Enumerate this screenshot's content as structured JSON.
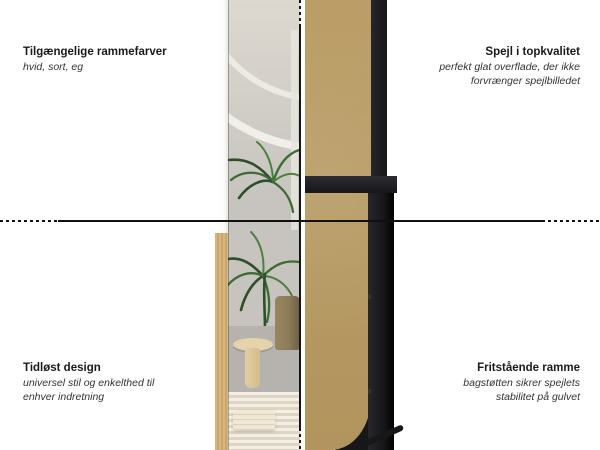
{
  "annotations": {
    "top_left": {
      "title": "Tilgængelige rammefarver",
      "description": "hvid, sort, eg"
    },
    "top_right": {
      "title": "Spejl i topkvalitet",
      "description": "perfekt glat overflade, der ikke\nforvrænger spejlbilledet"
    },
    "bottom_left": {
      "title": "Tidløst design",
      "description": "universel stil og enkelthed til\nenhver indretning"
    },
    "bottom_right": {
      "title": "Fritstående ramme",
      "description": "bagstøtten sikrer spejlets\nstabilitet på gulvet"
    }
  },
  "colors": {
    "text-strong": "#1a1a1a",
    "text-italic": "#333333",
    "line": "#111111",
    "mdf": "#b79a63",
    "oak": "#d6b67e",
    "frame-black": "#17171a",
    "wall-light": "#e9e5df",
    "wall-gray": "#c7c4bf",
    "floor": "#b6b3ae",
    "leaf-dark": "#2e4f2b",
    "leaf-mid": "#3c6b34",
    "leaf-light": "#4c8040",
    "rug-light": "#f3efe6",
    "rug-dark": "#ddd5c2",
    "stool": "#e7d3a9",
    "pot": "#8d7c5a",
    "white-frame": "#fbfbf9"
  }
}
